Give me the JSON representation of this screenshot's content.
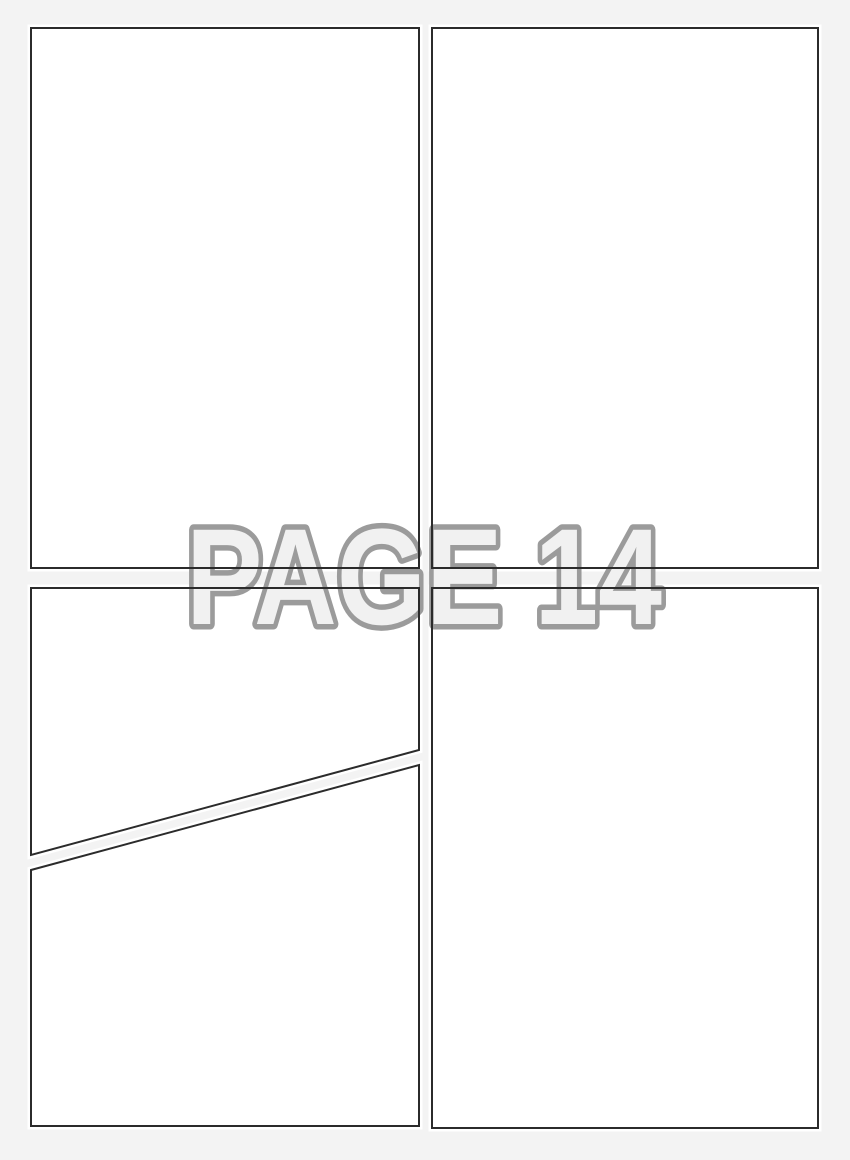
{
  "watermark": {
    "text": "PAGE 14"
  },
  "panels": {
    "count": 5
  },
  "colors": {
    "background": "#f3f3f3",
    "panel_fill": "#ffffff",
    "panel_border": "#2b2b2b",
    "watermark_fill": "#f1f1f1",
    "watermark_outline": "#9b9b9b"
  }
}
